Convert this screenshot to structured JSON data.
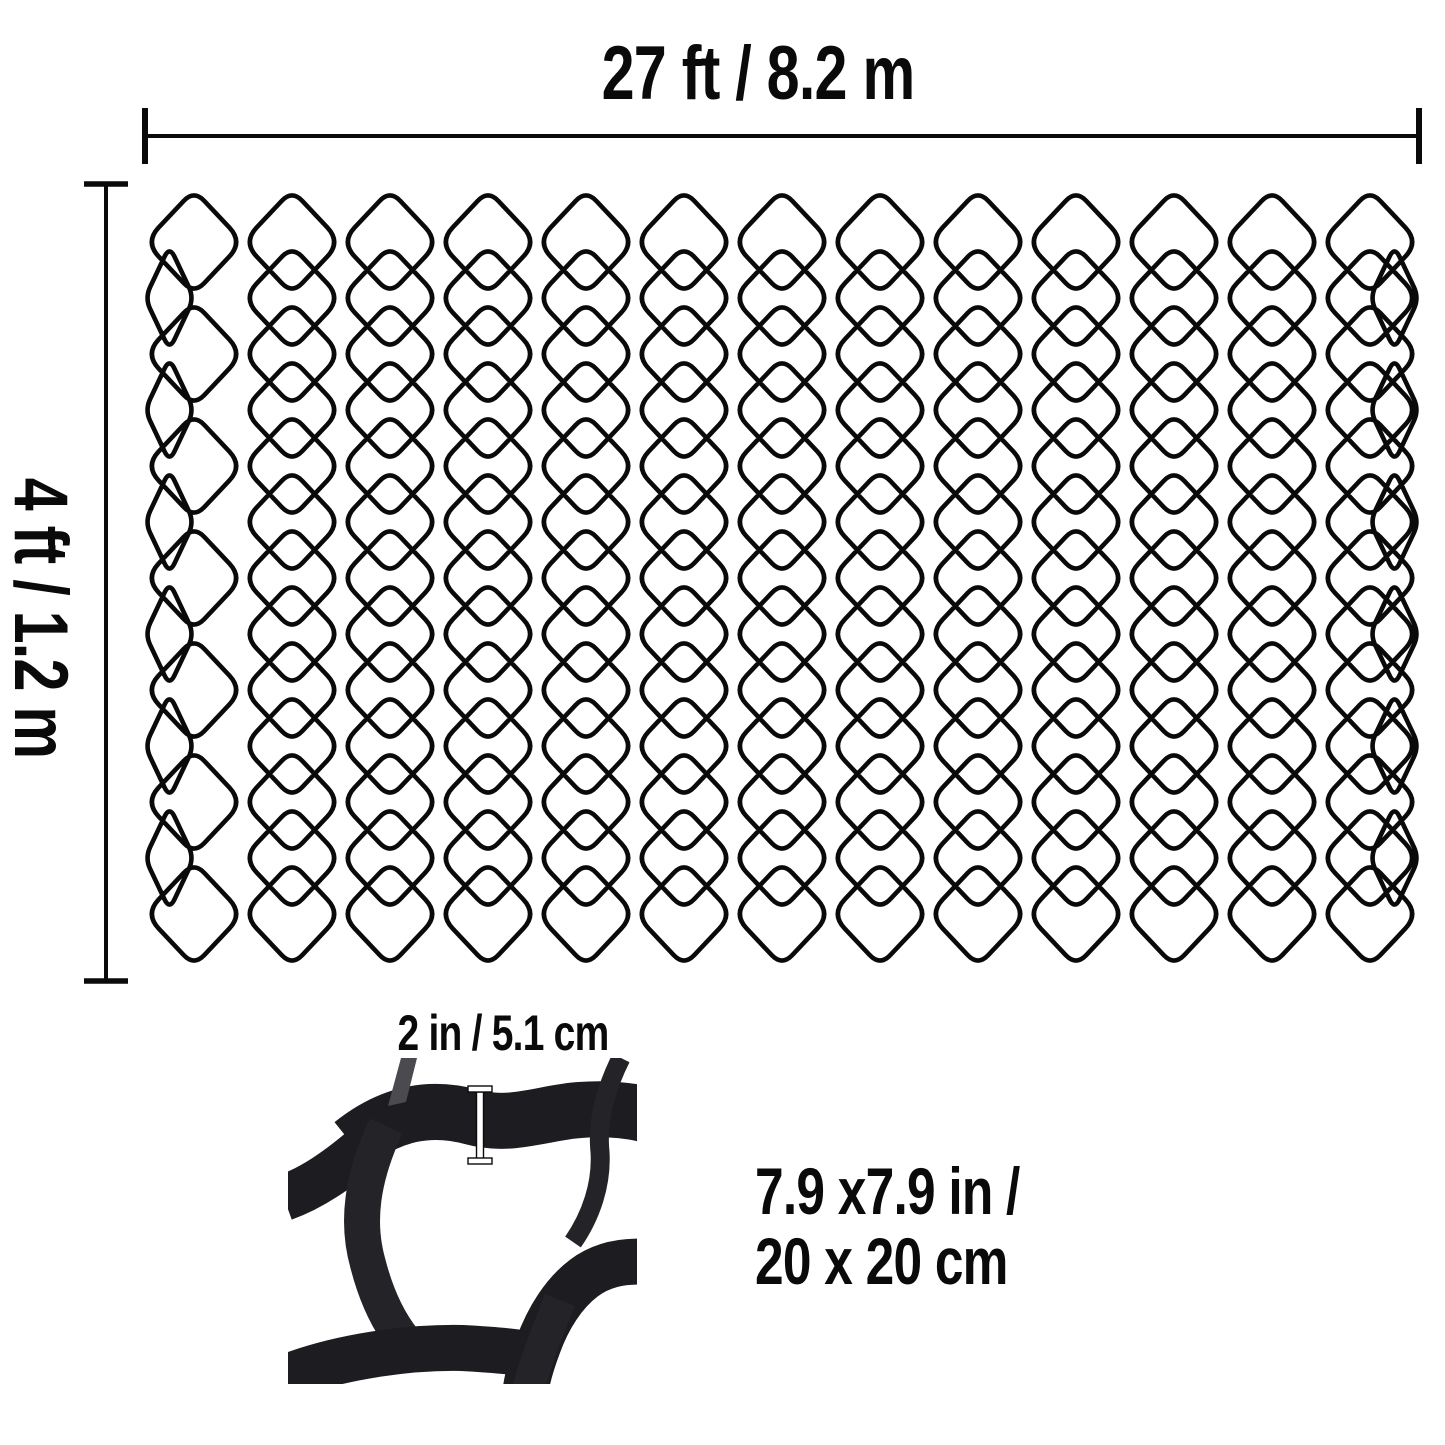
{
  "diagram": {
    "top_dimension": "27 ft / 8.2 m",
    "side_dimension": "4 ft / 1.2 m",
    "cell_depth": "2 in / 5.1 cm",
    "cell_size_line1": "7.9 x7.9 in /",
    "cell_size_line2": "20 x 20 cm"
  },
  "colors": {
    "background": "#ffffff",
    "line": "#0a0a0a",
    "text": "#0a0a0a",
    "strip_dark": "#1d1d21",
    "strip_mid": "#242428",
    "strip_light": "#4a4a4f",
    "marker_fill": "#ffffff"
  },
  "mesh": {
    "rows": 13,
    "full_cells_per_row": 13,
    "cell_width_px": 98,
    "cell_height_px": 104,
    "row_spacing_px": 56,
    "left_px": 145,
    "first_row_center_y_px": 242
  }
}
